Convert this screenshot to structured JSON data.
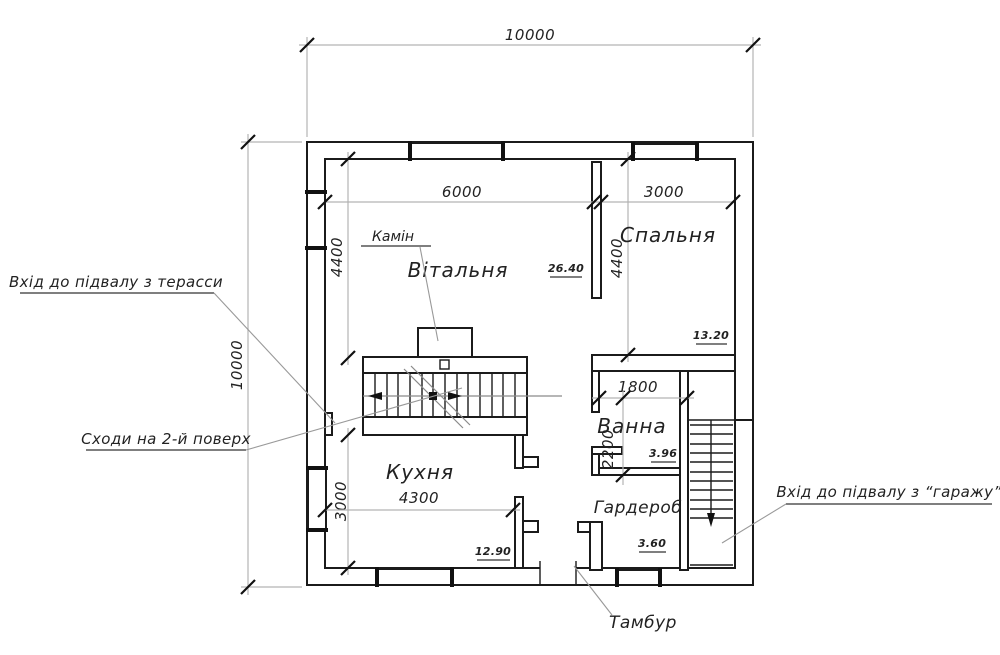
{
  "title": "Floor plan — first floor",
  "colors": {
    "wall": "#1b1b1b",
    "dimension_line": "#b3b3b3",
    "text": "#222222",
    "background": "#ffffff"
  },
  "rooms": {
    "vitalnya": {
      "label": "Вітальня",
      "area": "26.40"
    },
    "spalnya": {
      "label": "Спальня",
      "area": "13.20"
    },
    "vanna": {
      "label": "Ванна",
      "area": "3.96"
    },
    "garderob": {
      "label": "Гардероб",
      "area": "3.60"
    },
    "kuhnya": {
      "label": "Кухня",
      "area": "12.90"
    },
    "tambur": {
      "label": "Тамбур"
    },
    "kamin": {
      "label": "Камін"
    }
  },
  "dimensions": {
    "top_width": "10000",
    "left_height": "10000",
    "living_width": "6000",
    "bedroom_width": "3000",
    "living_depth": "4400",
    "bedroom_depth": "4400",
    "bath_width": "1800",
    "bath_depth": "2200",
    "kitchen_depth": "3000",
    "kitchen_width": "4300"
  },
  "annotations": {
    "basement_terrace": "Вхід до підвалу з терасси",
    "stairs_second_floor": "Сходи на 2-й поверх",
    "basement_garage": "Вхід до підвалу з “гаражу”"
  }
}
